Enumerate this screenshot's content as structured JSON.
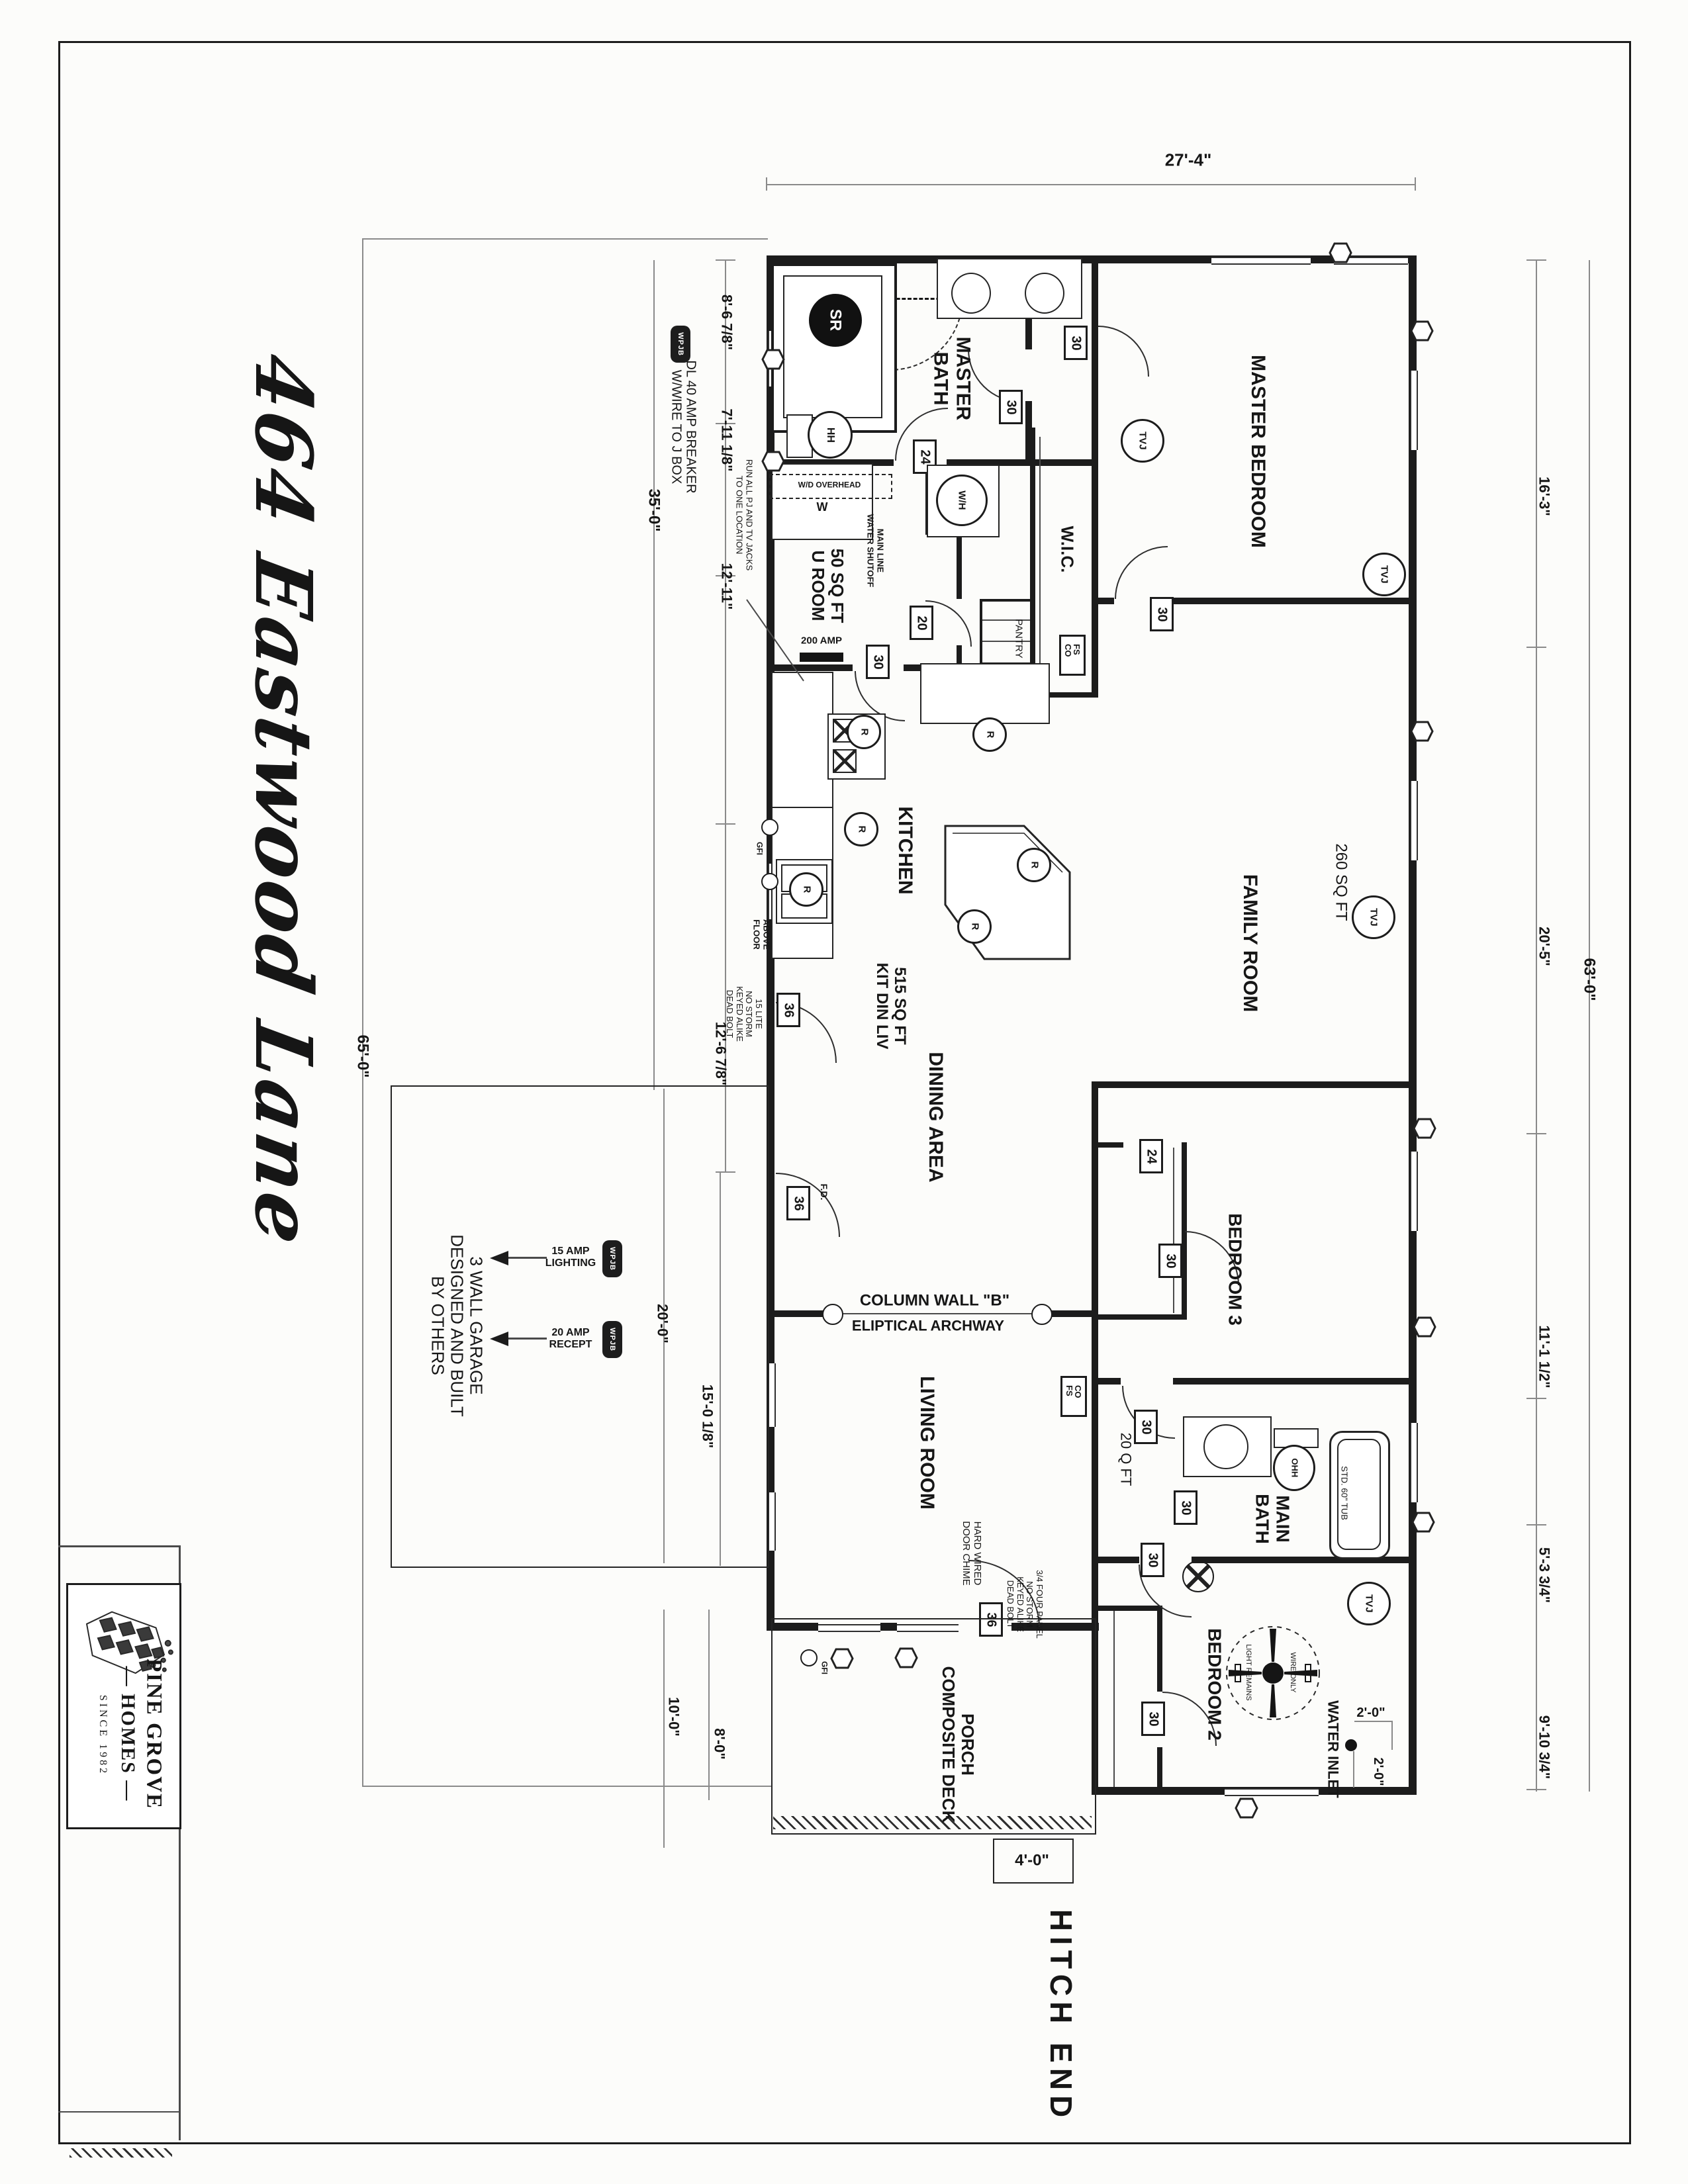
{
  "sheet": {
    "address": "464 Eastwood Lane",
    "hitch_end": "HITCH END",
    "logo": {
      "name_top": "PINE GROVE",
      "name_mid": "— HOMES —",
      "since": "S I N C E   1 9 8 2"
    }
  },
  "rooms": {
    "master_bath": "MASTER\nBATH",
    "master_bedroom": "MASTER BEDROOM",
    "wic": "W.I.C.",
    "u_room": "50 SQ FT\nU ROOM",
    "pantry": "PANTRY",
    "kitchen": "KITCHEN",
    "family_room": "FAMILY ROOM",
    "family_sqft": "260 SQ FT",
    "kit_din_liv": "515 SQ FT\nKIT DIN LIV",
    "dining": "DINING AREA",
    "living": "LIVING ROOM",
    "bedroom3": "BEDROOM 3",
    "main_bath": "MAIN\nBATH",
    "main_bath_sqft": "20 Q FT",
    "bedroom2": "BEDROOM 2",
    "porch": "PORCH\nCOMPOSITE DECK"
  },
  "dims": {
    "top": "27'-4\"",
    "left_1": "8'-6 7/8\"",
    "left_2": "7'-11 1/8\"",
    "left_3": "12'-11\"",
    "left_4": "12'-6 7/8\"",
    "left_35": "35'-0\"",
    "left_65": "65'-0\"",
    "garage_20": "20'-0\"",
    "living_15": "15'-0 1/8\"",
    "porch_10": "10'-0\"",
    "porch_8": "8'-0\"",
    "right_1": "16'-3\"",
    "right_2": "20'-5\"",
    "right_3": "11'-1 1/2\"",
    "right_4": "5'-3 3/4\"",
    "right_5": "9'-10 3/4\"",
    "right_63": "63'-0\"",
    "step": "4'-0\"",
    "inlet_a": "2'-0\"",
    "inlet_b": "2'-0\""
  },
  "notes": {
    "dl40": "DL 40 AMP BREAKER\nW/WIRE TO J BOX",
    "run_jacks": "RUN ALL PJ AND TV JACKS\nTO ONE LOCATION",
    "door_15lite": "15 LITE\nNO STORM\nKEYED ALIKE\nDEAD BOLT",
    "door_front": "3/4 FOUR PANEL\nNO STORM\nKEYED ALIKE\nDEAD BOLT",
    "chime": "HARD WIRED\nDOOR CHIME",
    "garage": "3 WALL GARAGE\nDESIGNED AND BUILT\nBY OTHERS",
    "amp15": "15 AMP\nLIGHTING",
    "amp20": "20 AMP\nRECEPT",
    "wd": "W/D OVERHEAD",
    "main_line": "MAIN LINE\nWATER SHUTOFF",
    "above_floor": "ABOVE\nFLOOR",
    "light_remains": "LIGHT REMAINS",
    "wire_only": "WIRE ONLY",
    "tub": "STD. 60\" TUB",
    "water_inlet": "WATER INLET",
    "column_wall": "COLUMN WALL \"B\"",
    "archway": "ELIPTICAL ARCHWAY",
    "panel": "200 AMP",
    "fd": "F.D.",
    "gfi": "GFI"
  },
  "symbols": {
    "tvj": "TVJ",
    "pj": "PJ",
    "r": "R",
    "sr": "SR",
    "hh": "HH",
    "ohh": "OHH",
    "wh": "W/H",
    "w": "W",
    "fs_co": "FS\nCO",
    "co_fs": "CO\nFS",
    "wpjb": "WPJB"
  },
  "doors": {
    "d36": "36",
    "d30": "30",
    "d24": "24",
    "d20": "20"
  }
}
